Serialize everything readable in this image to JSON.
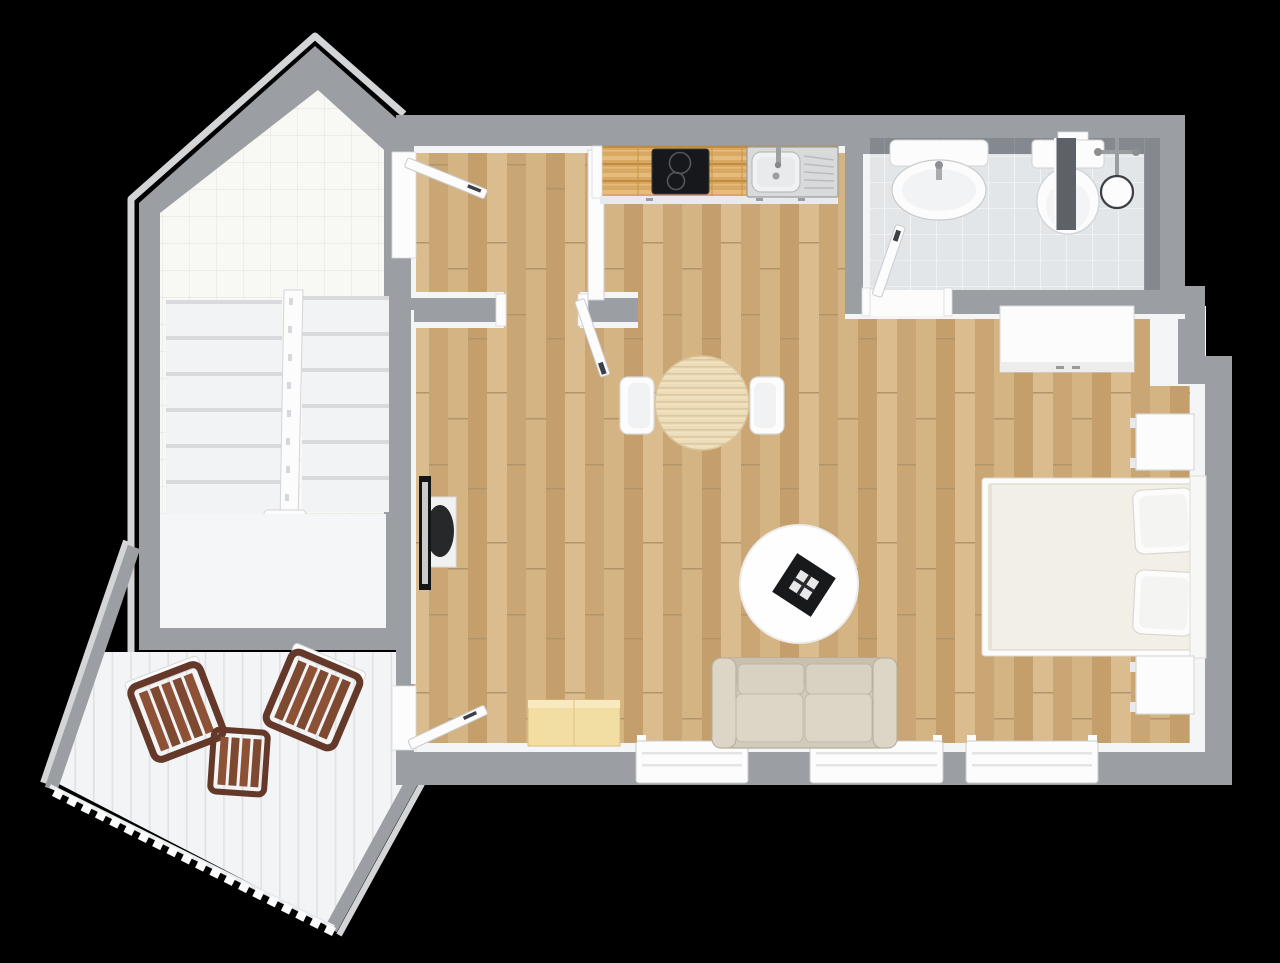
{
  "scene": {
    "type": "floor-plan-3d-top-view",
    "background": "#000000",
    "rooms": [
      {
        "name": "staircase-hall",
        "floor": "white-tile",
        "items": [
          "double-flight-staircase",
          "stair-railing",
          "landing"
        ]
      },
      {
        "name": "entry-hall",
        "floor": "oak-plank",
        "items": [
          "entry-door-open"
        ]
      },
      {
        "name": "kitchenette",
        "floor": "oak-plank",
        "items": [
          "butcher-block-counter",
          "two-burner-cooktop",
          "stainless-sink-with-drainboard"
        ]
      },
      {
        "name": "bathroom",
        "floor": "grey-tile",
        "items": [
          "wall-sink",
          "toilet",
          "glass-shower-screen",
          "shower-head",
          "shower-mixer",
          "door-open"
        ]
      },
      {
        "name": "living-bedroom",
        "floor": "oak-plank",
        "items": [
          "round-dining-table",
          "two-dining-chairs",
          "wall-tv-unit",
          "round-rug",
          "black-coffee-table",
          "two-seat-sofa",
          "double-bed",
          "two-pillows",
          "two-nightstands",
          "white-dresser",
          "storage-bench",
          "three-windows"
        ]
      },
      {
        "name": "terrace",
        "floor": "white-deck-boards",
        "items": [
          "two-slatted-wood-chairs",
          "slatted-wood-side-table",
          "railing",
          "terrace-door-open"
        ]
      }
    ],
    "counts": {
      "doors_open": 4,
      "windows": 3,
      "stairs_flights": 2,
      "terrace_chairs": 2
    }
  },
  "colors": {
    "bg": "#000000",
    "wall": "#9b9ea3",
    "wall_face": "#f4f5f7",
    "eave": "#d4d5d7",
    "tile": "#f8f8f4",
    "tile_grid": "#e7e7e0",
    "wood1": "#cfae7c",
    "wood2": "#c49f6b",
    "wood3": "#dabc8e",
    "wood4": "#c9a673",
    "wood5": "#d4b483",
    "wood_seam": "#b2946b",
    "counter": "#d9a963",
    "counter_hi": "#e5bc7c",
    "counter_lo": "#c08d3f",
    "bath_floor": "#e2e6e9",
    "bath_grid": "#f3f5f7",
    "bath_band": "#848990",
    "stair": "#f2f3f5",
    "step_edge": "#d9dade",
    "landing": "#f5f6f8",
    "deck": "#f3f4f6",
    "deck_line": "#dfe1e4",
    "brown": "#7d4a31",
    "brown_dark": "#64392a",
    "brown_slat": "#8d5136",
    "white_furn": "#fcfcfd",
    "outline_soft": "#cdd0d3",
    "sofa1": "#d2cbbb",
    "sofa2": "#c8c1b0",
    "sofa3": "#ddd6c6",
    "sofa_line": "#b0a997",
    "duvet": "#f1efe6",
    "duvet_line": "#ded9c8",
    "rug": "#fefefe",
    "blackf": "#17181b",
    "steel": "#d8dadb",
    "steel_dark": "#9da0a3",
    "glass": "#5d6168",
    "bench": "#f2dda2",
    "bench_hi": "#f8e9c0",
    "bench_lo": "#d9bd7e"
  }
}
